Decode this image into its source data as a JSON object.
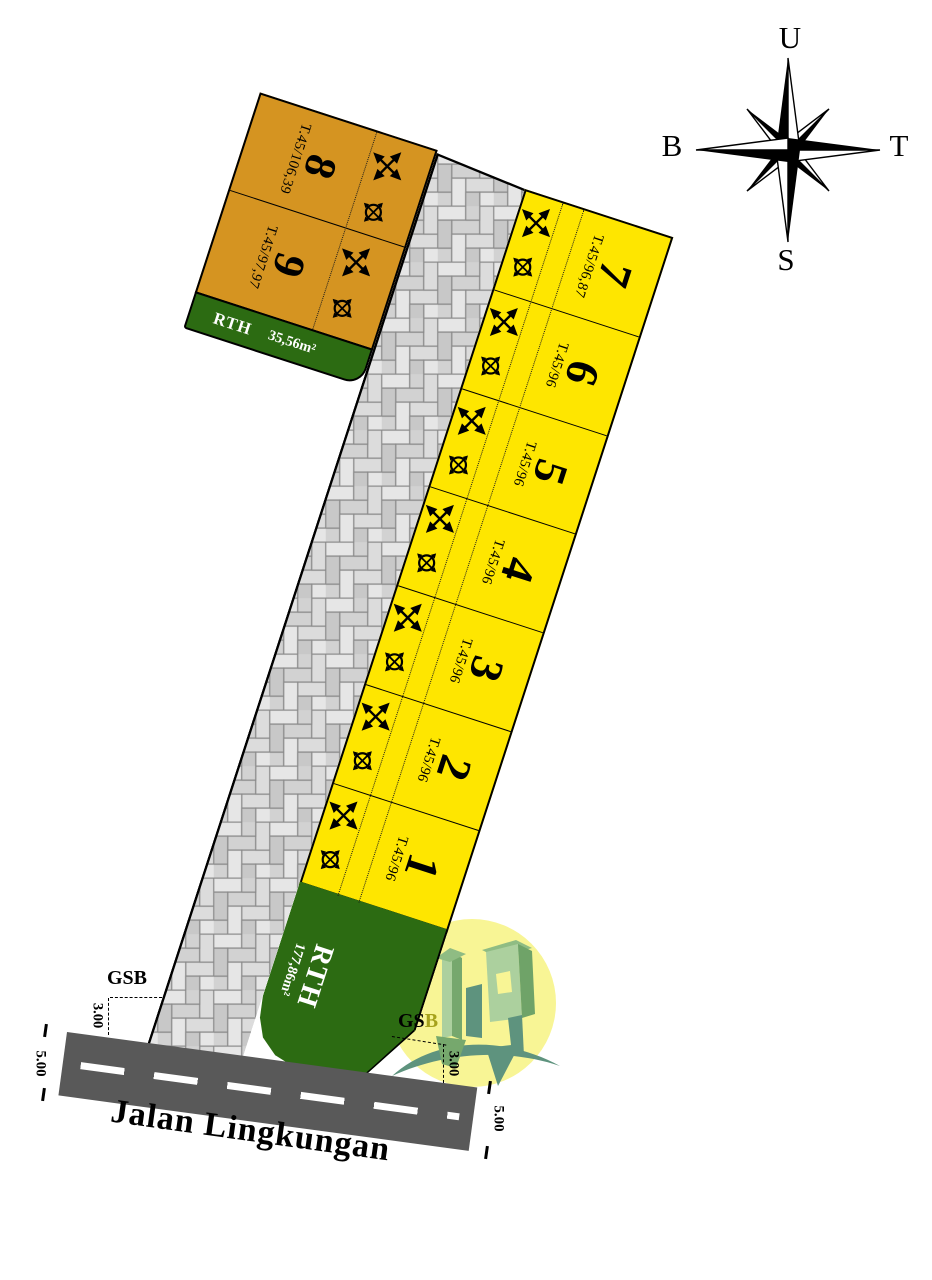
{
  "compass": {
    "north": "U",
    "east": "T",
    "south": "S",
    "west": "B"
  },
  "plots": {
    "yellow": [
      {
        "num": "7",
        "type": "T.45/96,87"
      },
      {
        "num": "6",
        "type": "T.45/96"
      },
      {
        "num": "5",
        "type": "T.45/96"
      },
      {
        "num": "4",
        "type": "T.45/96"
      },
      {
        "num": "3",
        "type": "T.45/96"
      },
      {
        "num": "2",
        "type": "T.45/96"
      },
      {
        "num": "1",
        "type": "T.45/96"
      }
    ],
    "orange": [
      {
        "num": "8",
        "type": "T.45/106,39"
      },
      {
        "num": "9",
        "type": "T.45/97,97"
      }
    ]
  },
  "green_spaces": {
    "rth_small": {
      "label": "RTH",
      "area": "35,56m²"
    },
    "rth_large": {
      "label": "RTH",
      "area": "177,86m²"
    }
  },
  "road": {
    "name": "Jalan Lingkungan"
  },
  "dimensions": {
    "left": {
      "gsb": "GSB",
      "setback": "3.00",
      "road_width": "5.00"
    },
    "right": {
      "gsb_black": "GS",
      "gsb_olive": "B",
      "setback": "3.00",
      "road_width": "5.00"
    }
  },
  "colors": {
    "plot_yellow": "#FEE600",
    "plot_orange": "#D59421",
    "rth_green": "#2C6B12",
    "road_gray": "#595959",
    "paver_gray": "#DCDCDC",
    "logo_yellow": "#F8F595",
    "logo_green": "#ACD09E"
  }
}
